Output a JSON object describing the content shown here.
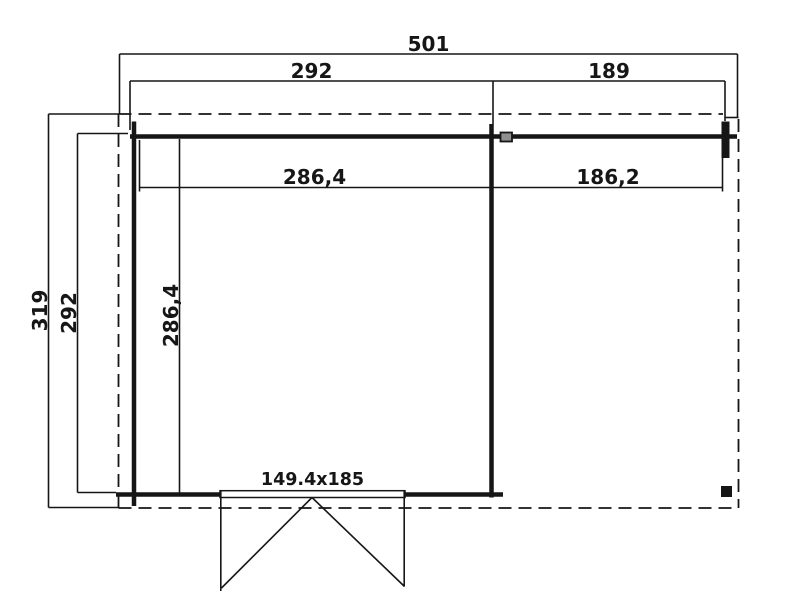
{
  "colors": {
    "line": "#161616",
    "background": "#ffffff",
    "marker": "#8f8f8f"
  },
  "plan": {
    "kind": "cabin-floor-plan",
    "labels": {
      "overall_width": "501",
      "cabin_width": "292",
      "annex_width": "189",
      "cabin_inner_width": "286,4",
      "annex_inner_width": "186,2",
      "overall_depth": "319",
      "cabin_depth": "292",
      "cabin_inner_depth": "286,4",
      "door_size": "149.4x185"
    }
  }
}
